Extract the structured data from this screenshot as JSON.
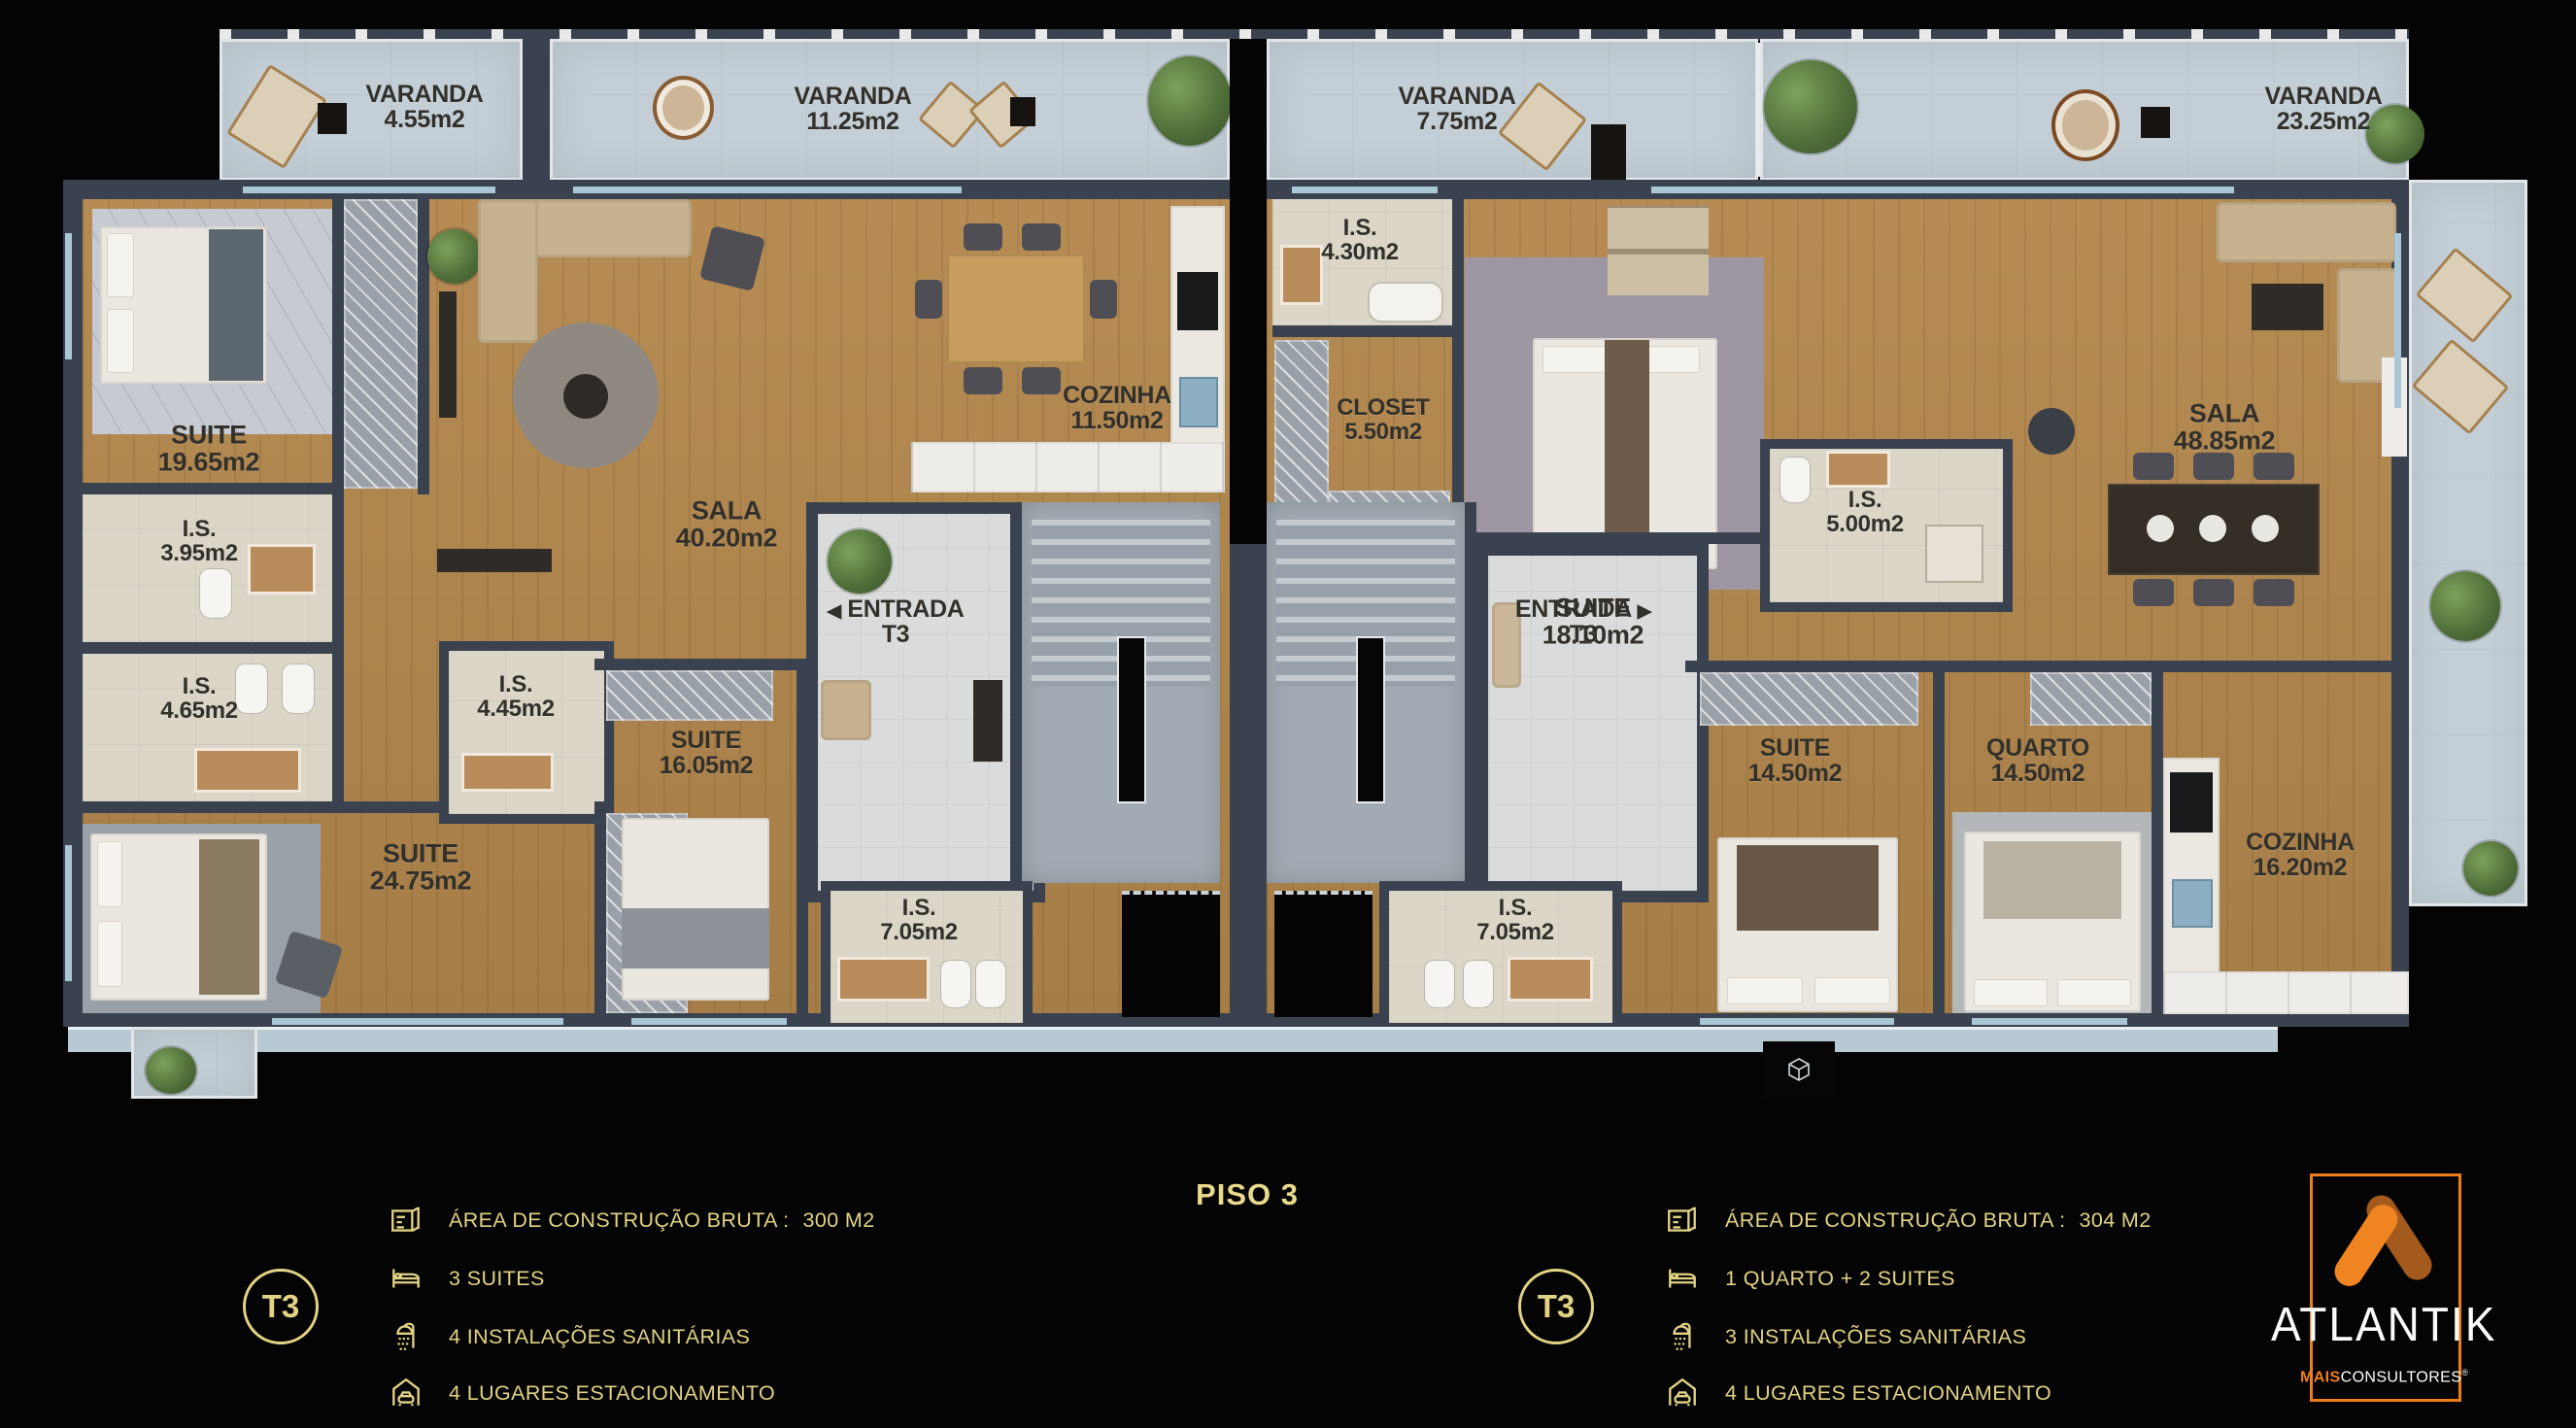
{
  "floor_title": "PISO 3",
  "colors": {
    "gold": "#e2d384",
    "orange": "#ee7f1d",
    "orange_dark": "#a55a1d",
    "wall": "#39424e",
    "wood": "#b08a52",
    "bath_tile": "#dcd6c9",
    "balcony": "#c3ced6",
    "background": "#040404"
  },
  "rooms": [
    {
      "name": "VARANDA",
      "area": "4.55m2"
    },
    {
      "name": "VARANDA",
      "area": "11.25m2"
    },
    {
      "name": "VARANDA",
      "area": "7.75m2"
    },
    {
      "name": "VARANDA",
      "area": "23.25m2"
    },
    {
      "name": "SUITE",
      "area": "19.65m2"
    },
    {
      "name": "I.S.",
      "area": "3.95m2"
    },
    {
      "name": "I.S.",
      "area": "4.65m2"
    },
    {
      "name": "I.S.",
      "area": "4.45m2"
    },
    {
      "name": "SUITE",
      "area": "24.75m2"
    },
    {
      "name": "SUITE",
      "area": "16.05m2"
    },
    {
      "name": "SALA",
      "area": "40.20m2"
    },
    {
      "name": "COZINHA",
      "area": "11.50m2"
    },
    {
      "name": "ENTRADA",
      "area": "T3",
      "arrow": "◀"
    },
    {
      "name": "I.S.",
      "area": "7.05m2"
    },
    {
      "name": "I.S.",
      "area": "4.30m2"
    },
    {
      "name": "CLOSET",
      "area": "5.50m2"
    },
    {
      "name": "SUITE",
      "area": "18.10m2"
    },
    {
      "name": "I.S.",
      "area": "5.00m2"
    },
    {
      "name": "SALA",
      "area": "48.85m2"
    },
    {
      "name": "ENTRADA",
      "area": "T3",
      "arrow": "▶"
    },
    {
      "name": "SUITE",
      "area": "14.50m2"
    },
    {
      "name": "QUARTO",
      "area": "14.50m2"
    },
    {
      "name": "COZINHA",
      "area": "16.20m2"
    },
    {
      "name": "I.S.",
      "area": "7.05m2"
    }
  ],
  "legend_left": {
    "badge": "T3",
    "rows": [
      {
        "label": "ÁREA DE CONSTRUÇÃO BRUTA :",
        "value": "300 M2"
      },
      {
        "label": "3 SUITES"
      },
      {
        "label": "4 INSTALAÇÕES SANITÁRIAS"
      },
      {
        "label": "4 LUGARES ESTACIONAMENTO"
      }
    ]
  },
  "legend_right": {
    "badge": "T3",
    "rows": [
      {
        "label": "ÁREA DE CONSTRUÇÃO BRUTA :",
        "value": "304 M2"
      },
      {
        "label": "1 QUARTO + 2 SUITES"
      },
      {
        "label": "3 INSTALAÇÕES SANITÁRIAS"
      },
      {
        "label": "4 LUGARES ESTACIONAMENTO"
      }
    ]
  },
  "logo": {
    "brand": "ATLANTIK",
    "tagline_bold": "MAIS",
    "tagline": "CONSULTORES",
    "registered": "®"
  }
}
